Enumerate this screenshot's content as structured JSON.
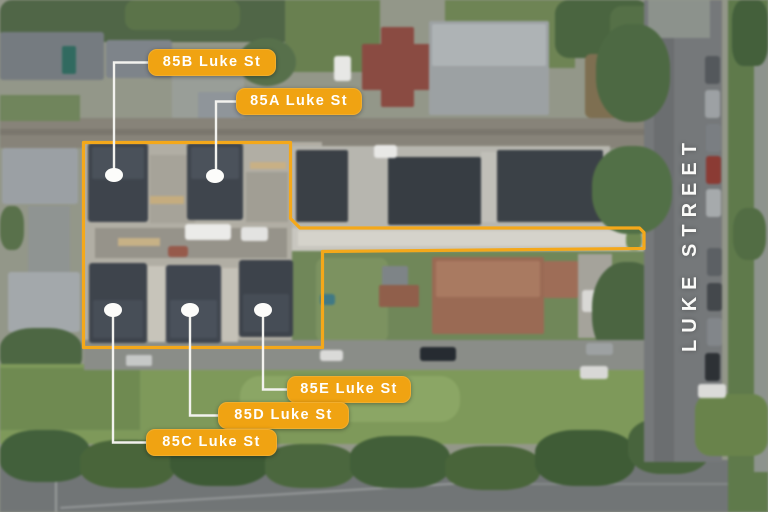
{
  "scene": {
    "street_label": "LUKE STREET",
    "labels": [
      {
        "id": "85b",
        "text": "85B Luke St"
      },
      {
        "id": "85a",
        "text": "85A Luke St"
      },
      {
        "id": "85e",
        "text": "85E Luke St"
      },
      {
        "id": "85d",
        "text": "85D Luke St"
      },
      {
        "id": "85c",
        "text": "85C Luke St"
      }
    ],
    "colors": {
      "label_background": "#F0A312",
      "label_text": "#FFFFFF",
      "boundary_outline": "#F4A81A",
      "leader_line": "#F2F2EE",
      "marker_dot": "#FCFCFA",
      "street_text": "#FAFAF8"
    }
  }
}
